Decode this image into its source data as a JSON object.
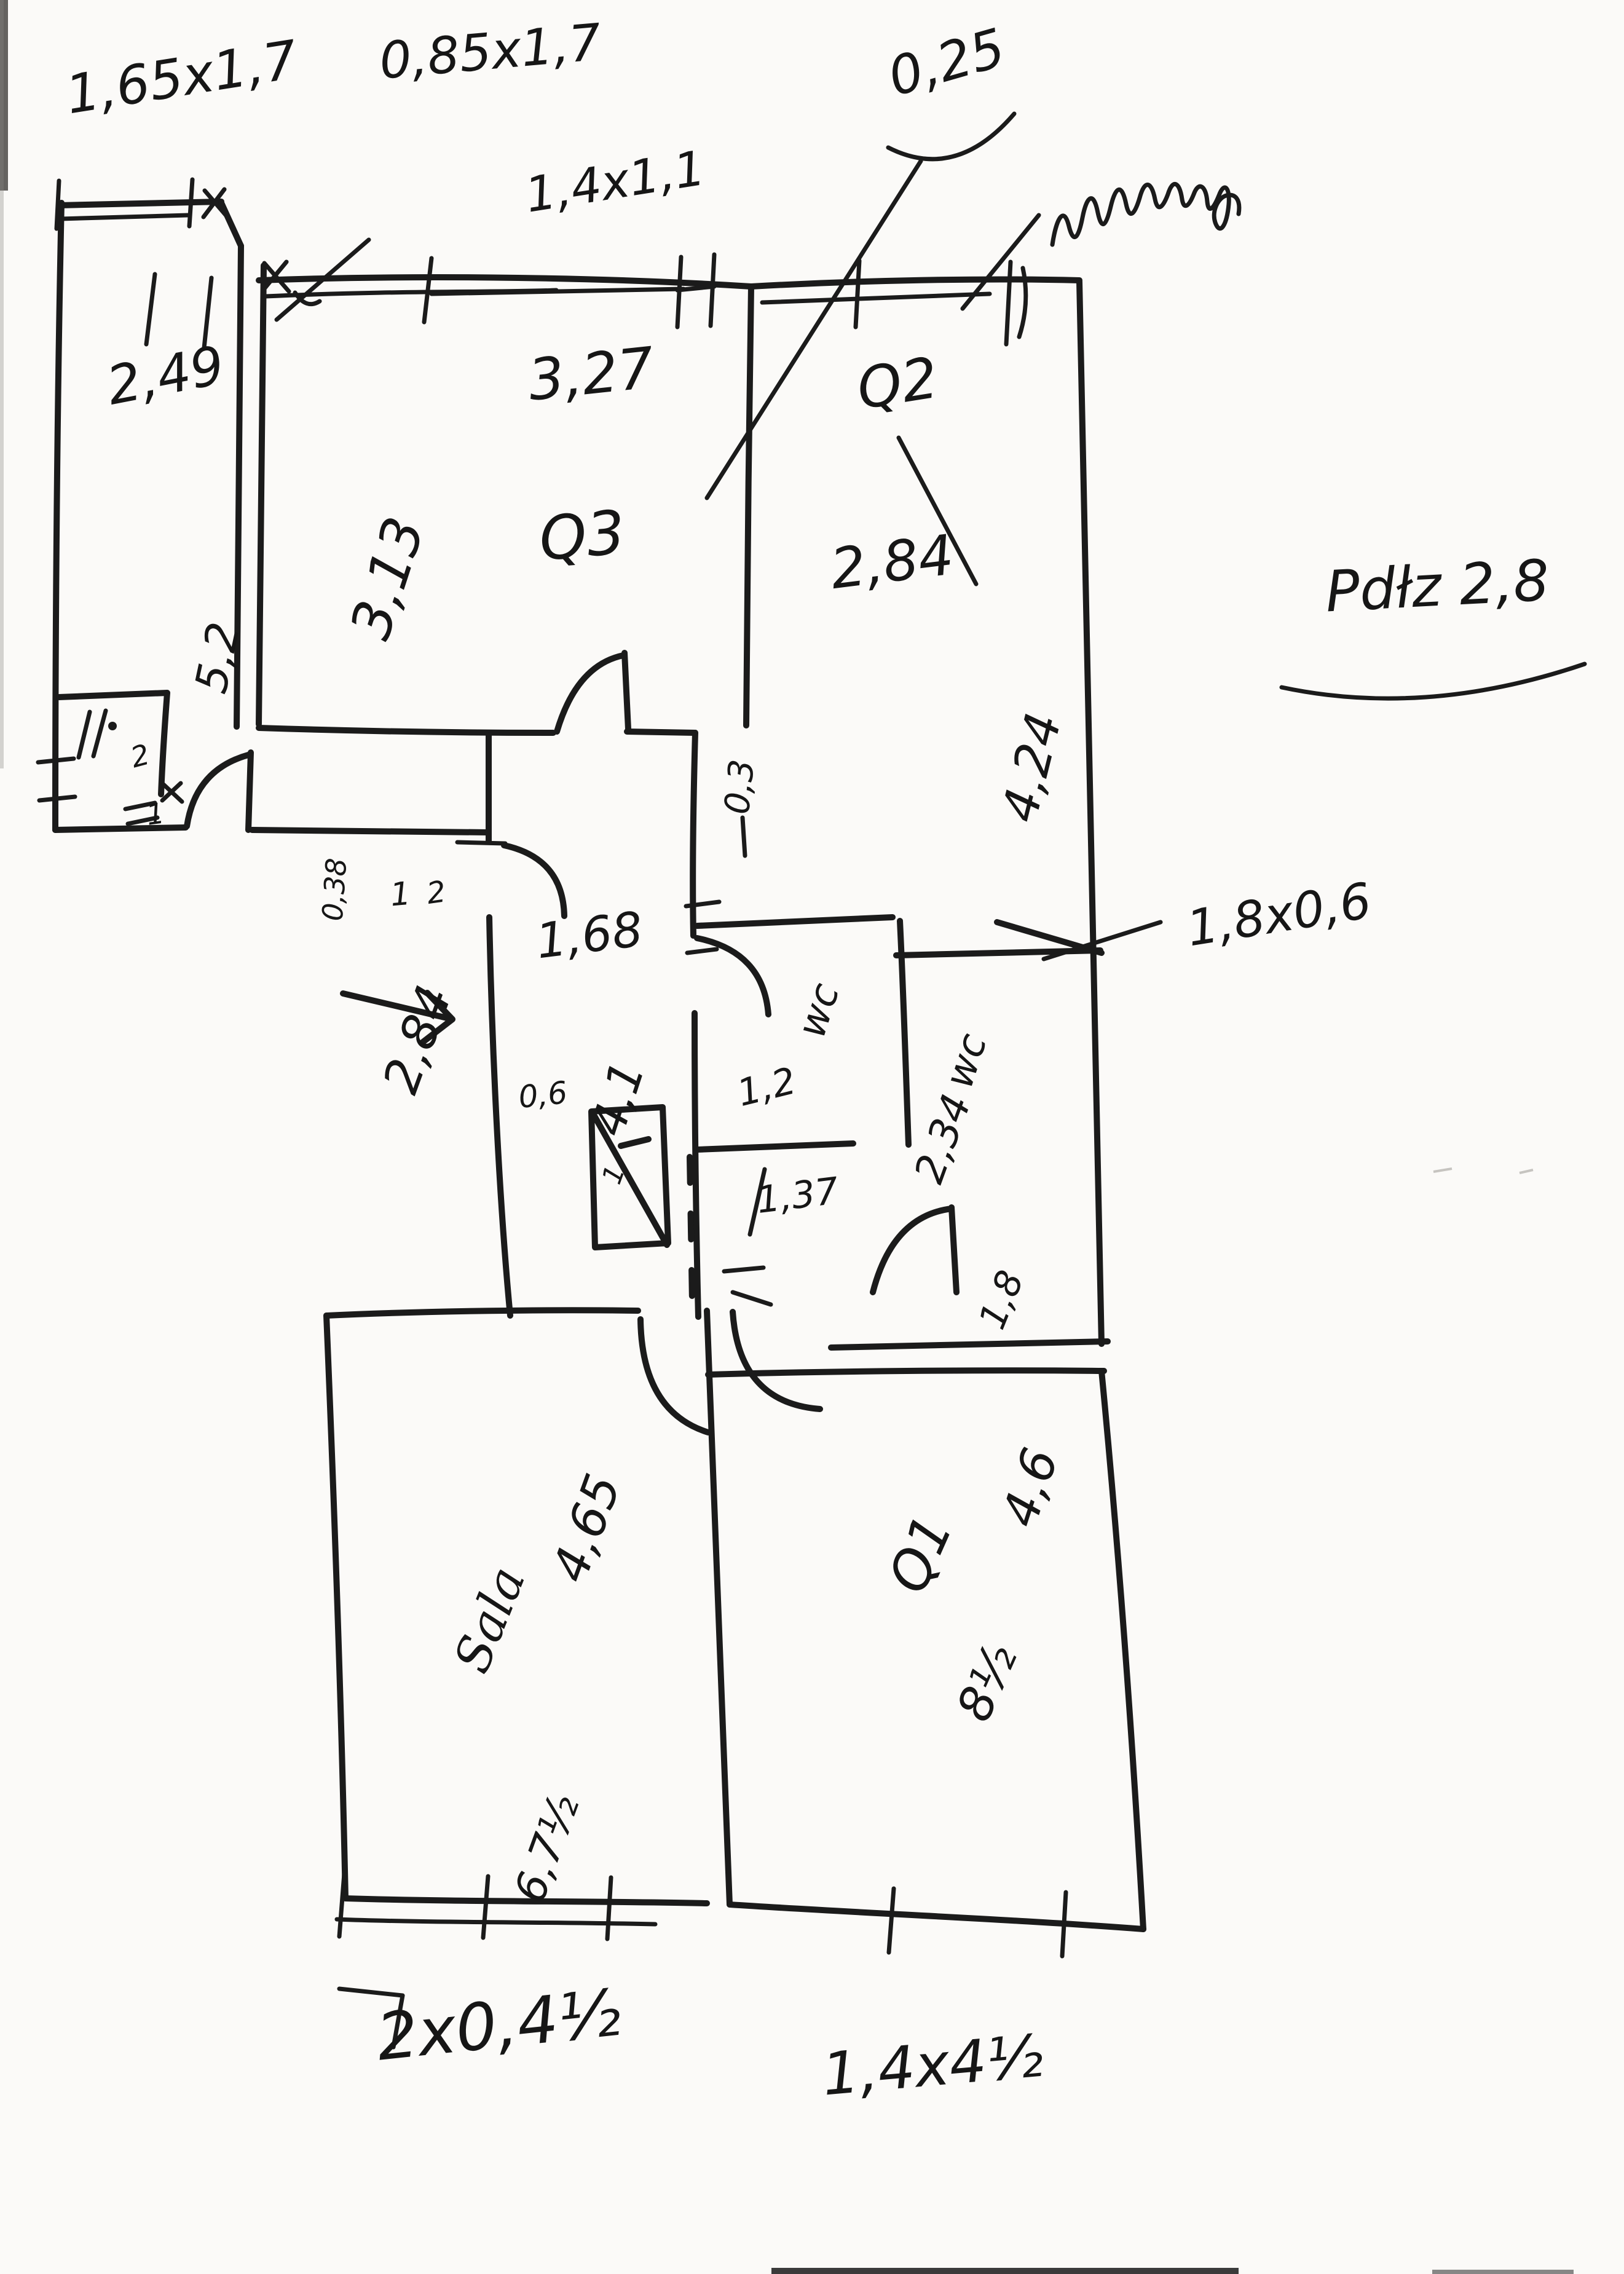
{
  "document": {
    "kind": "hand-drawn floor plan sketch",
    "medium": "black marker on white paper",
    "ink_color": "#1b1b1b",
    "paper_color": "#fbfaf8"
  },
  "labels": {
    "top_note_a": "1,65x1,7",
    "top_note_b": "0,85x1,7",
    "top_note_c": "1,4x1,1",
    "top_note_d": "0,25",
    "side_note": "Pdłz 2,8",
    "room_tl_dim_w": "2,49",
    "room_tl_dim_h": "5,2",
    "q3_dim_w": "3,27",
    "q3_name": "Q3",
    "q3_dim_h": "3,13",
    "q2_name": "Q2",
    "q2_dim_w": "2,84",
    "q2_dim_h": "4,24",
    "corridor_wall": "0,3",
    "corridor_dim_w": "1,68",
    "corridor_dim_h": "4,1",
    "corridor_dim_len": "2,84",
    "passage_dim": "0,38",
    "entrance_mark_1": "1",
    "entrance_mark_2": "2",
    "annex_mark": "2",
    "annex_door_mark": "1",
    "shaft_dim": "0,6",
    "shaft_mark": "1",
    "wc1_name": "wc",
    "wc1_dim": "1,2",
    "wc1_len": "1,37",
    "wc2_name": "wc",
    "wc2_dim": "2,34",
    "wc2_width": "1,8",
    "window_note": "1,8x0,6",
    "sala_name": "Sala",
    "sala_dim_w": "4,65",
    "sala_dim_b": "6,7½",
    "q1_dim_h": "4,6",
    "q1_name": "Q1",
    "q1_dim_b": "8½",
    "bottom_note_a": "2x0,4½",
    "bottom_note_b": "1,4x4½"
  }
}
